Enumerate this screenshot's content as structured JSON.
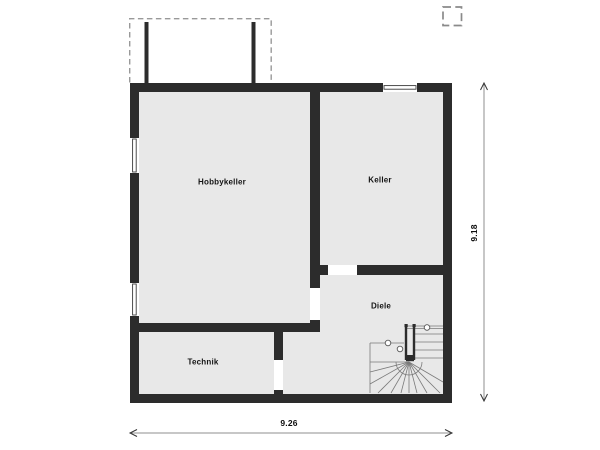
{
  "title": "Kellergeschoss Grundriss",
  "rooms": {
    "hobbykeller": "Hobbykeller",
    "keller": "Keller",
    "diele": "Diele",
    "technik": "Technik"
  },
  "dimensions": {
    "width": "9.26",
    "height": "9.18"
  },
  "features": {
    "staircase": "winder-stair",
    "terrace_outline": "dashed-overhang",
    "chimney_marker": "dashed-square"
  },
  "colors": {
    "floor": "#e8e8e8",
    "wall": "#2c2c2c",
    "dash": "#999999",
    "dim_line": "#8f8f8f",
    "stair_line": "#7a7a7a",
    "text": "#141414",
    "background": "#ffffff"
  }
}
